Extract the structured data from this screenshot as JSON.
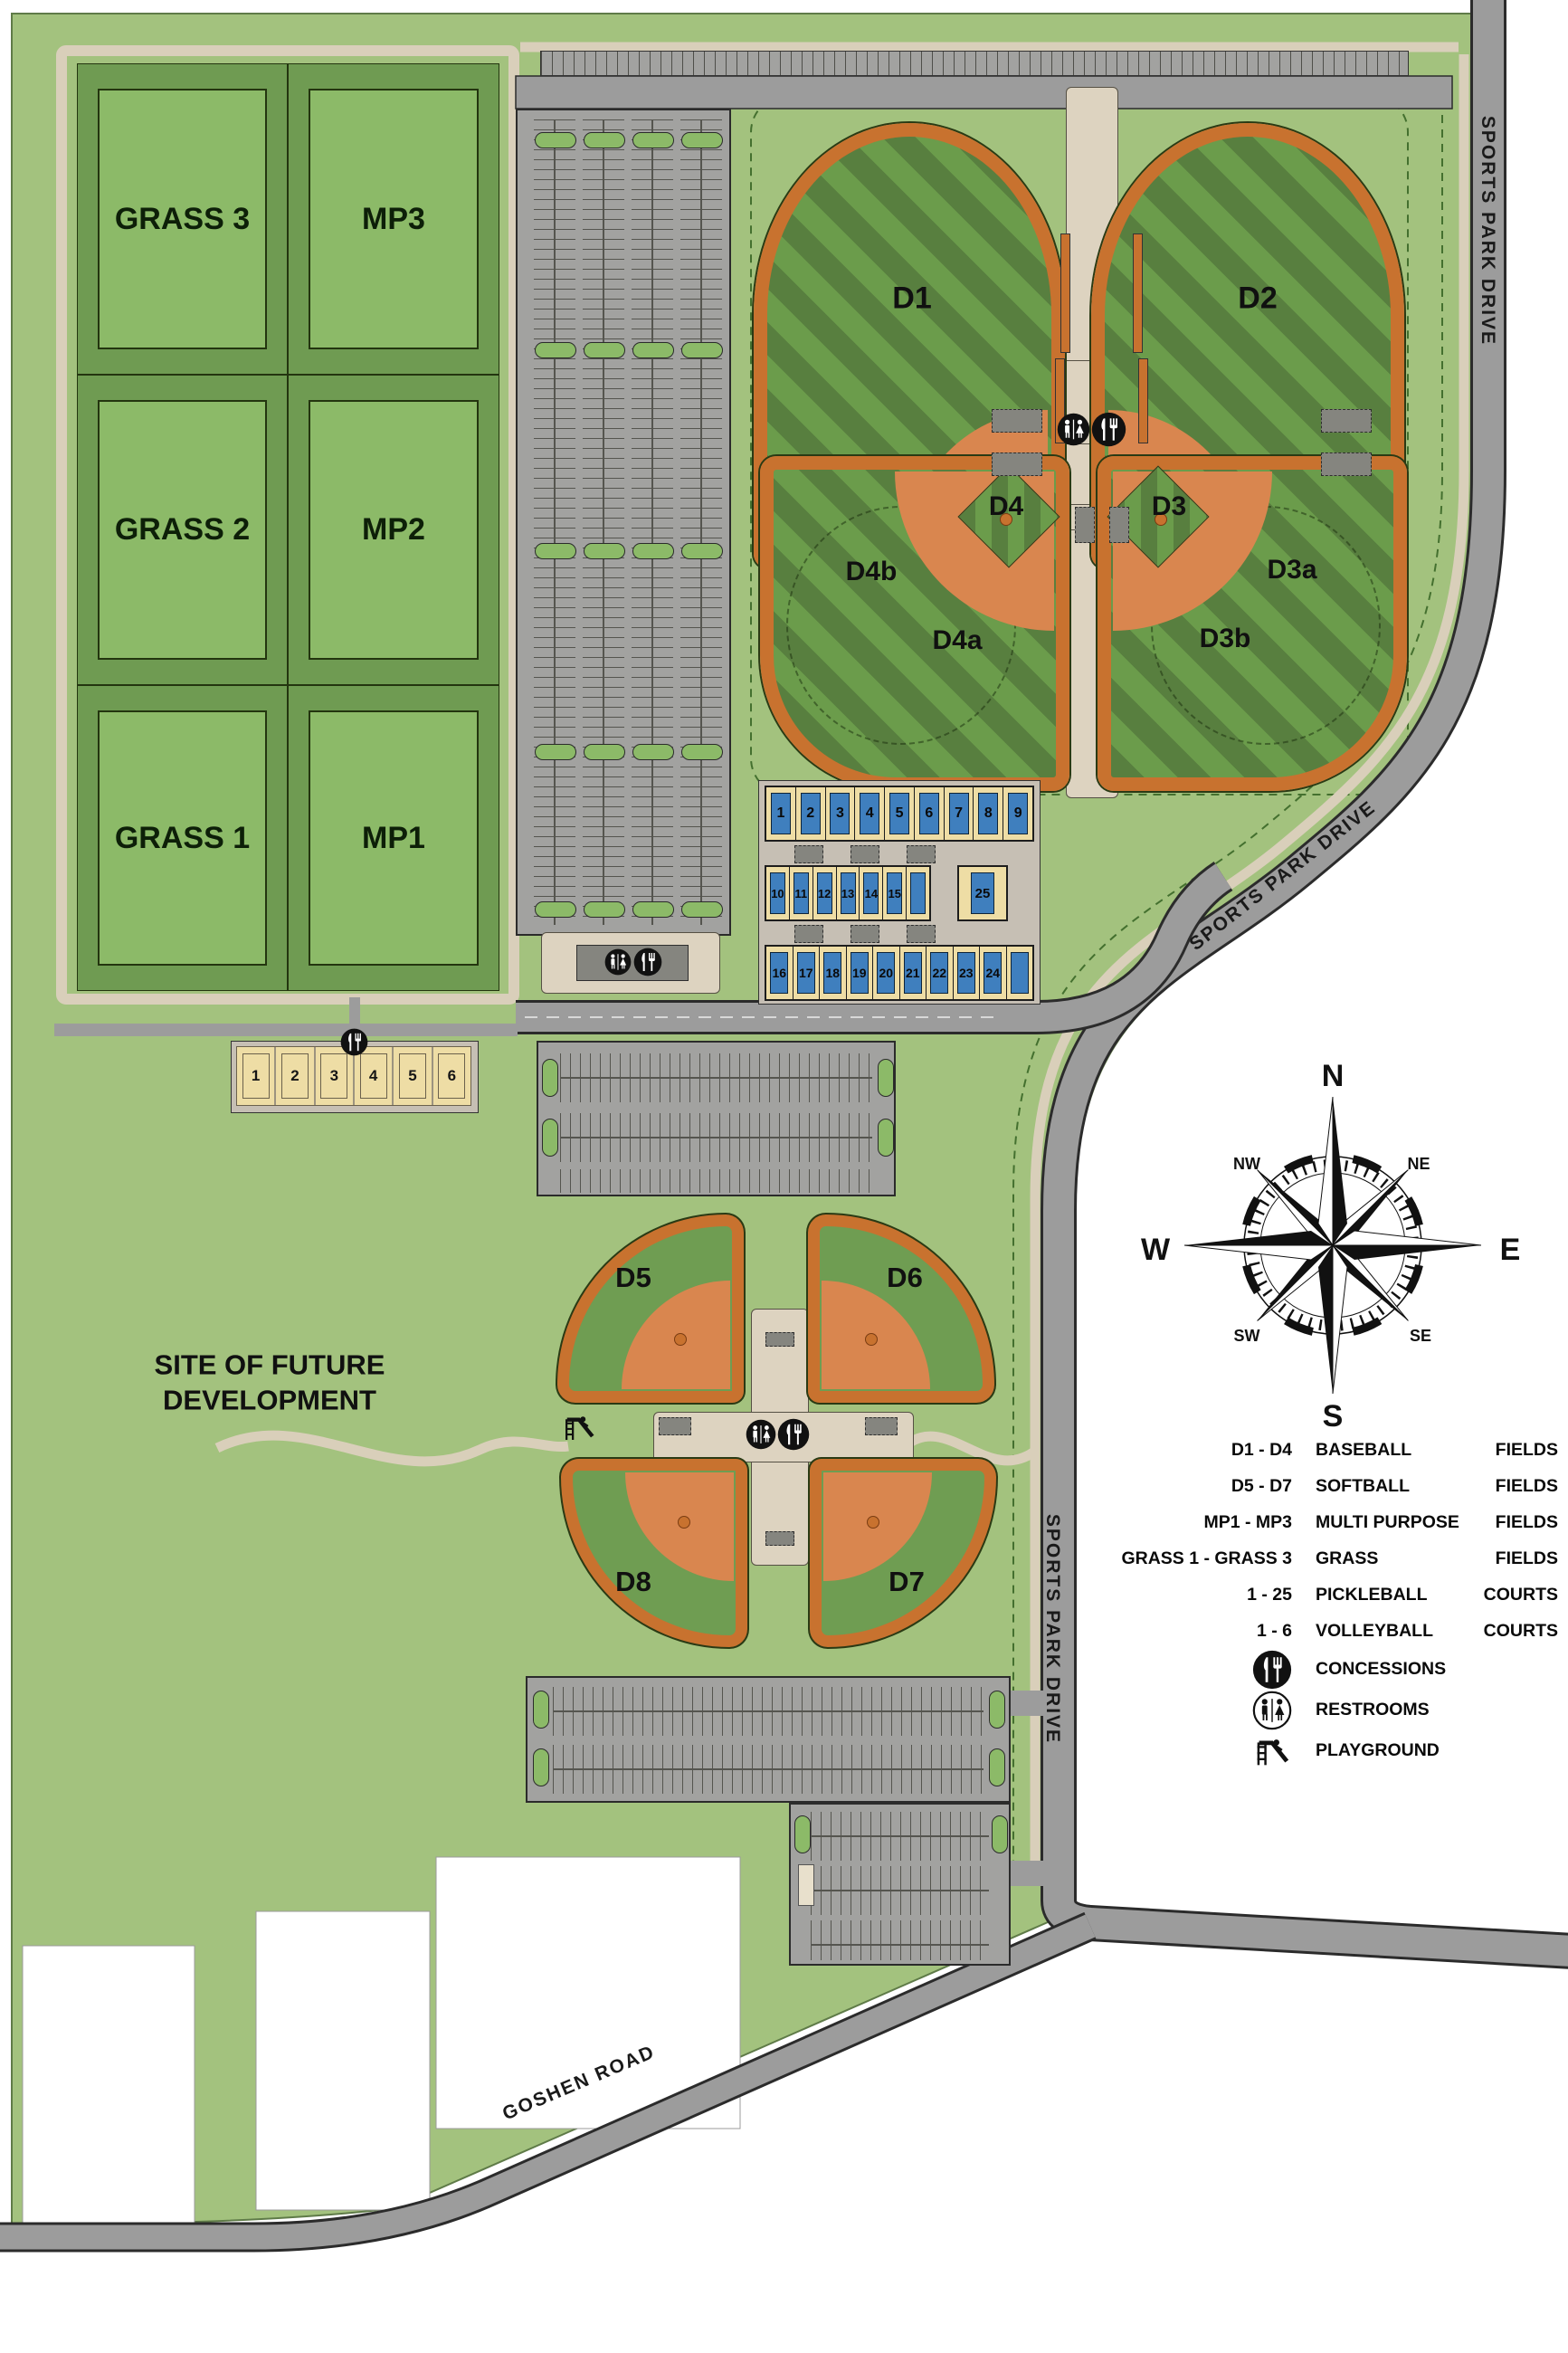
{
  "park": {
    "future_site_label": "SITE OF FUTURE DEVELOPMENT",
    "roads": {
      "sports_park_drive": "SPORTS PARK DRIVE",
      "goshen_road": "GOSHEN ROAD"
    },
    "fields": {
      "grass_mp": [
        [
          "GRASS 3",
          "MP3"
        ],
        [
          "GRASS 2",
          "MP2"
        ],
        [
          "GRASS 1",
          "MP1"
        ]
      ],
      "baseball": {
        "d1": "D1",
        "d2": "D2",
        "d3": "D3",
        "d3a": "D3a",
        "d3b": "D3b",
        "d4": "D4",
        "d4a": "D4a",
        "d4b": "D4b"
      },
      "softball": {
        "d5": "D5",
        "d6": "D6",
        "d7": "D7",
        "d8": "D8"
      }
    },
    "pickleball": {
      "row1": [
        "1",
        "2",
        "3",
        "4",
        "5",
        "6",
        "7",
        "8",
        "9"
      ],
      "row2": [
        "10",
        "11",
        "12",
        "13",
        "14",
        "15"
      ],
      "court25": "25",
      "row3": [
        "16",
        "17",
        "18",
        "19",
        "20",
        "21",
        "22",
        "23",
        "24"
      ]
    },
    "volleyball": [
      "1",
      "2",
      "3",
      "4",
      "5",
      "6"
    ]
  },
  "compass": {
    "n": "N",
    "ne": "NE",
    "e": "E",
    "se": "SE",
    "s": "S",
    "sw": "SW",
    "w": "W",
    "nw": "NW"
  },
  "legend": {
    "items": [
      {
        "code": "D1 - D4",
        "label": "BASEBALL",
        "type": "FIELDS"
      },
      {
        "code": "D5 - D7",
        "label": "SOFTBALL",
        "type": "FIELDS"
      },
      {
        "code": "MP1 - MP3",
        "label": "MULTI PURPOSE",
        "type": "FIELDS"
      },
      {
        "code": "GRASS 1 - GRASS 3",
        "label": "GRASS",
        "type": "FIELDS"
      },
      {
        "code": "1 - 25",
        "label": "PICKLEBALL",
        "type": "COURTS"
      },
      {
        "code": "1 - 6",
        "label": "VOLLEYBALL",
        "type": "COURTS"
      }
    ],
    "concessions": "CONCESSIONS",
    "restrooms": "RESTROOMS",
    "playground": "PLAYGROUND"
  },
  "colors": {
    "park_green": "#a3c27e",
    "cell_green": "#6f9b52",
    "field_green": "#8cba68",
    "outfield_dark": "#587f3f",
    "outfield_light": "#6b9c4b",
    "clay_orange": "#c8722f",
    "infield_orange": "#d9864f",
    "road_gray": "#9c9c9c",
    "lot_gray": "#a2a2a0",
    "path_tan": "#d9cfba",
    "plaza_tan": "#ddd3c0",
    "court_blue": "#3f7fbe",
    "court_tan": "#eedda5"
  }
}
